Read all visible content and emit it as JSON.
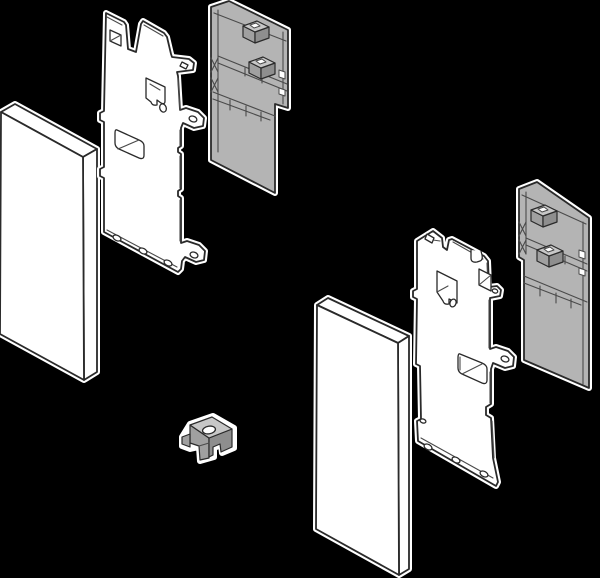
{
  "canvas": {
    "width": 600,
    "height": 578,
    "background": "#000000"
  },
  "colors": {
    "bg": "#000000",
    "part-white": "#ffffff",
    "part-gray": "#b4b4b4",
    "outline": "#2a2a2a",
    "inner": "#4a4a4a",
    "halo": "#ffffff",
    "clamp-top": "#c7c7c7",
    "clamp-front": "#a0a0a0",
    "clamp-side": "#8e8e8e"
  },
  "diagram": {
    "kind": "exploded-isometric-assembly-illustration",
    "description": "Exploded view of left and right drawer front fixing bracket sets: front panel, perforated steel bracket plate and gray bracket holder for each side, plus a small gray clamp nut in the center",
    "parts": [
      {
        "id": "left-front-panel",
        "label": "Front panel, left set",
        "material": "white"
      },
      {
        "id": "left-bracket",
        "label": "Steel fixing bracket plate, left",
        "material": "white"
      },
      {
        "id": "left-holder",
        "label": "Bracket holder housing, left",
        "material": "gray"
      },
      {
        "id": "center-clamp",
        "label": "Clamp nut with screw hole",
        "material": "gray"
      },
      {
        "id": "right-front-panel",
        "label": "Front panel, right set",
        "material": "white"
      },
      {
        "id": "right-bracket",
        "label": "Steel fixing bracket plate, right",
        "material": "white"
      },
      {
        "id": "right-holder",
        "label": "Bracket holder housing, right",
        "material": "gray"
      }
    ]
  }
}
